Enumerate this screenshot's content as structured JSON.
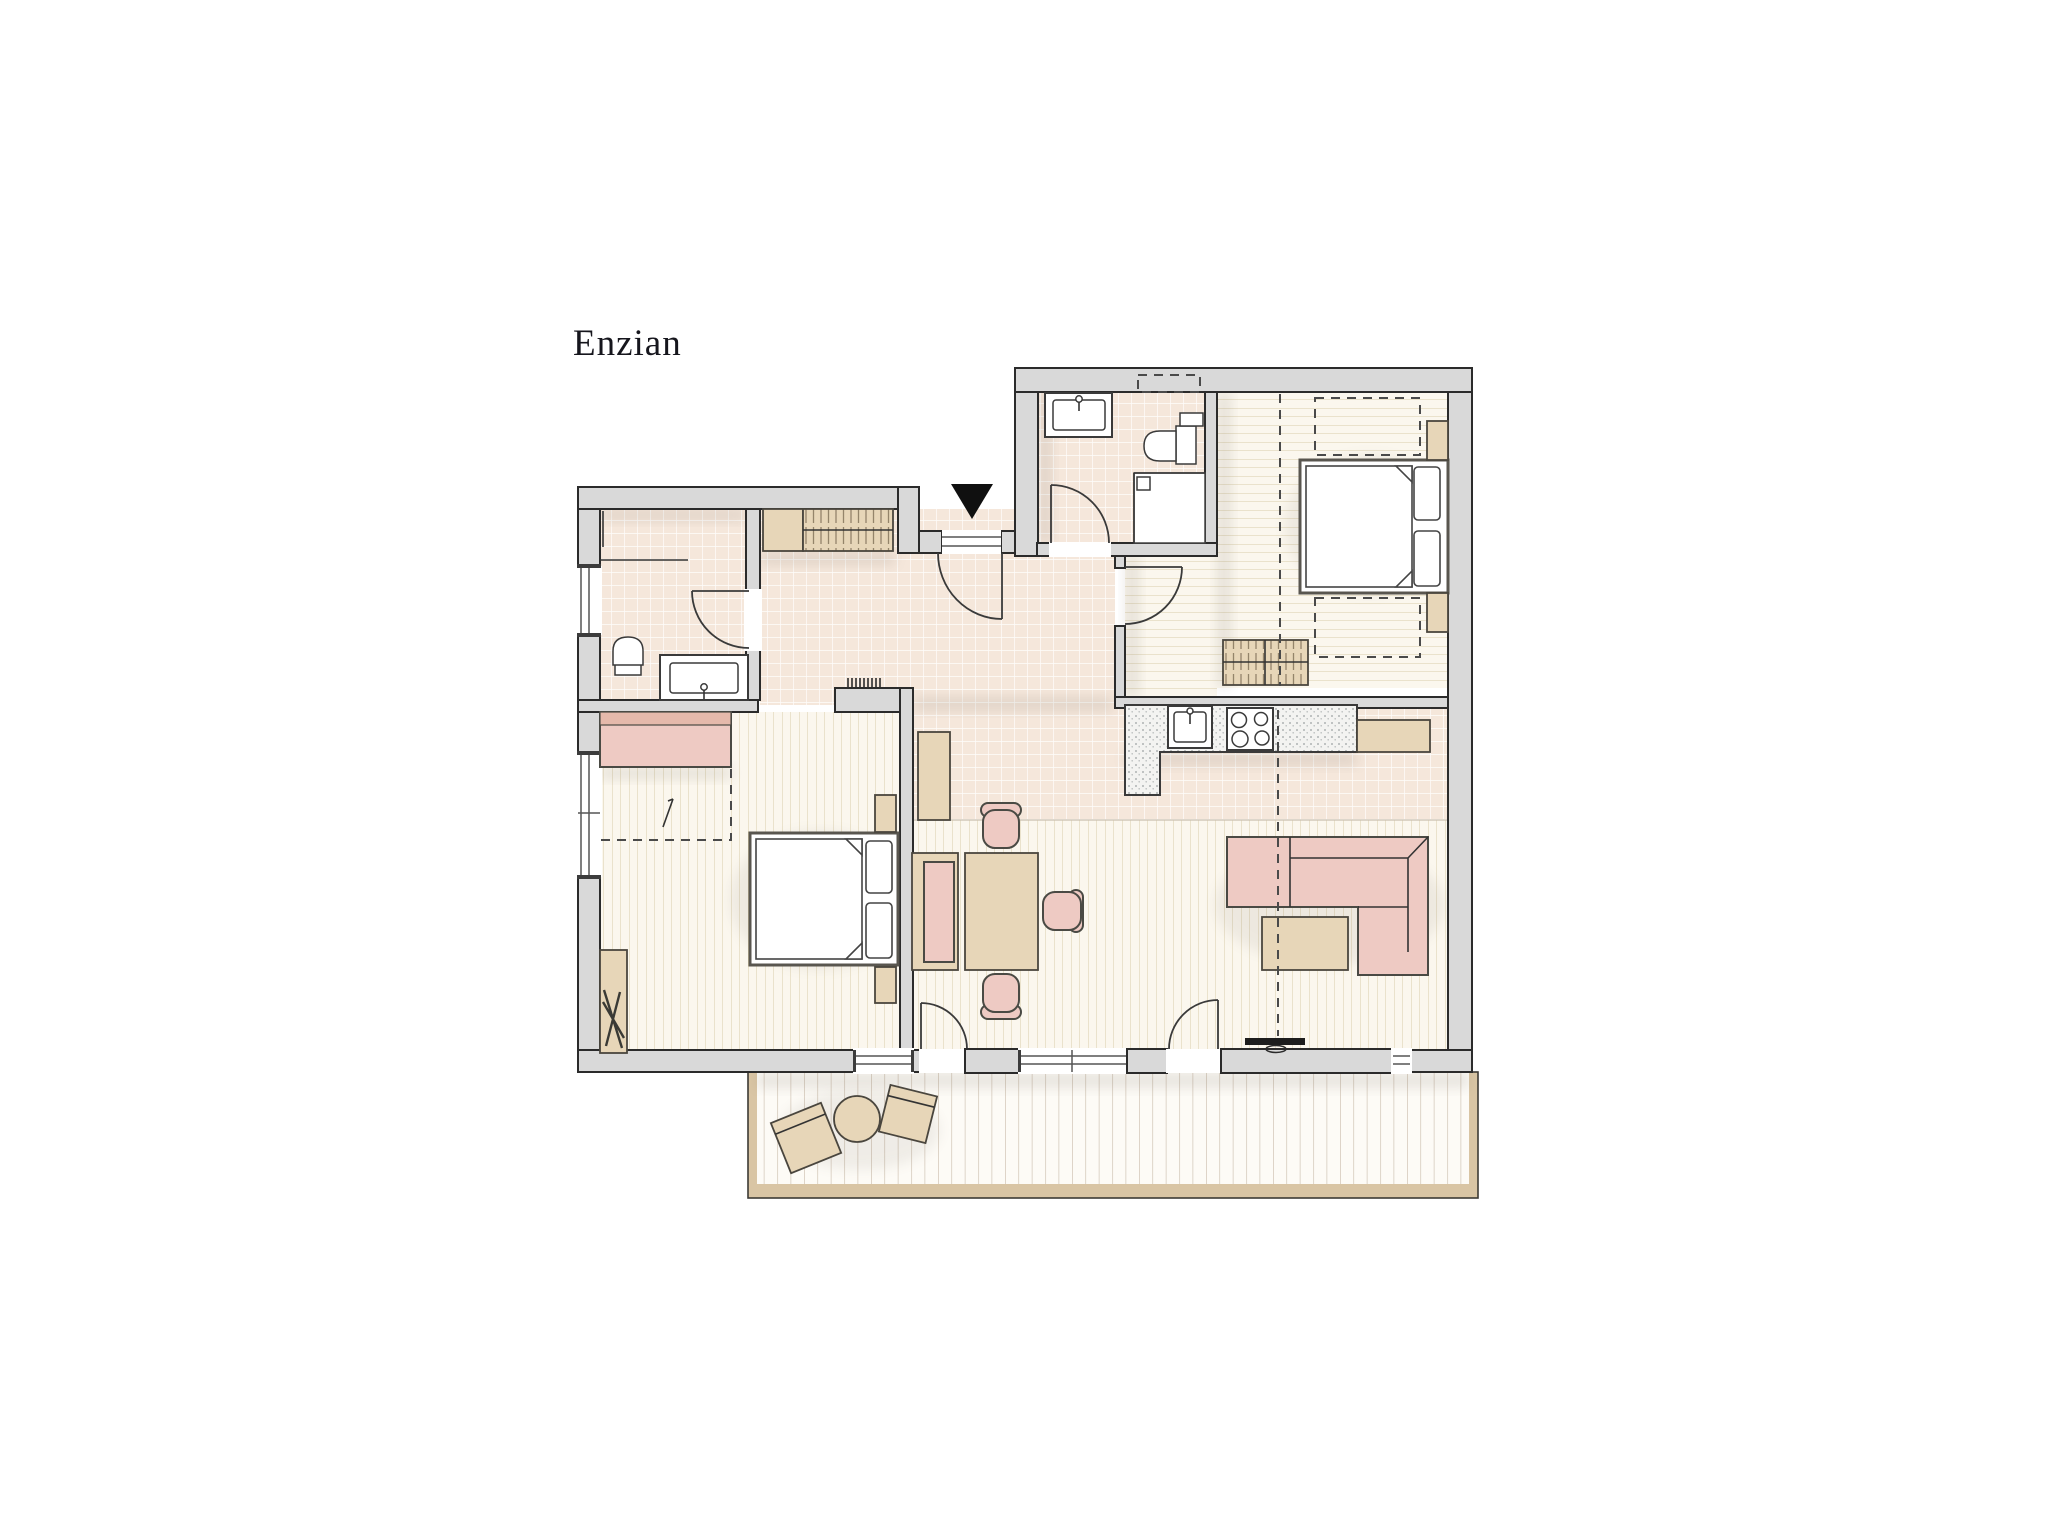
{
  "title": "Enzian",
  "theme": {
    "bg": "#ffffff",
    "wall-fill": "#d9d9d9",
    "wall-line": "#2b2b2b",
    "tile": "#f5e7db",
    "plank-bg": "#fbf7ee",
    "plank-line": "#d9cdaa",
    "balcony-bg": "#fdfbf6",
    "balcony-line": "#cabcaa",
    "balcony-frame": "#d9c5a4",
    "wood": "#e7d6b8",
    "wood-line": "#94846a",
    "pink": "#eecac3",
    "pink-dark": "#e5b9ab",
    "counter-bg": "#f3f3f1",
    "counter-dot": "#9aa0a0",
    "ink": "#16161d"
  },
  "floorplan": {
    "name": "apartment-floor-plan",
    "entry": {
      "marker": "entrance-arrow",
      "door": "entry-door"
    },
    "rooms": [
      {
        "id": "hallway",
        "floor": "tile",
        "items": [
          "built-in-wardrobe",
          "cabinet",
          "radiator",
          "entry-door"
        ]
      },
      {
        "id": "bathroom-1",
        "floor": "tile",
        "items": [
          "toilet",
          "washbasin-vanity",
          "shower-partition",
          "window",
          "door"
        ]
      },
      {
        "id": "bedroom-1",
        "floor": "wood-planks-vertical",
        "items": [
          "double-bed",
          "wardrobe",
          "nightstand-top",
          "nightstand-bottom",
          "desk",
          "chair",
          "side-window",
          "balcony-window",
          "roof-slope-dashed-line"
        ]
      },
      {
        "id": "bathroom-2",
        "floor": "tile",
        "items": [
          "washbasin-vanity",
          "toilet",
          "shower",
          "door",
          "dashed-niche"
        ]
      },
      {
        "id": "bedroom-2",
        "floor": "wood-planks-horizontal",
        "items": [
          "double-bed",
          "nightstand-top",
          "nightstand-bottom",
          "dresser",
          "door",
          "dashed-furniture-outline-top",
          "dashed-furniture-outline-bottom",
          "dashed-partition-line"
        ]
      },
      {
        "id": "living-dining-kitchen",
        "floor": "tile-and-wood-planks",
        "items": [
          "kitchen-counter",
          "kitchen-sink",
          "stove",
          "kitchen-cabinet",
          "tall-cabinet",
          "dining-table",
          "dining-bench",
          "dining-chair-top",
          "dining-chair-right",
          "dining-chair-bottom",
          "corner-sofa",
          "coffee-table",
          "tv-lowboard",
          "balcony-door-left",
          "balcony-door-right",
          "windows",
          "dashed-partition-line"
        ]
      },
      {
        "id": "balcony",
        "floor": "decking",
        "items": [
          "lounge-chair-left",
          "lounge-chair-right",
          "round-table"
        ]
      }
    ]
  }
}
